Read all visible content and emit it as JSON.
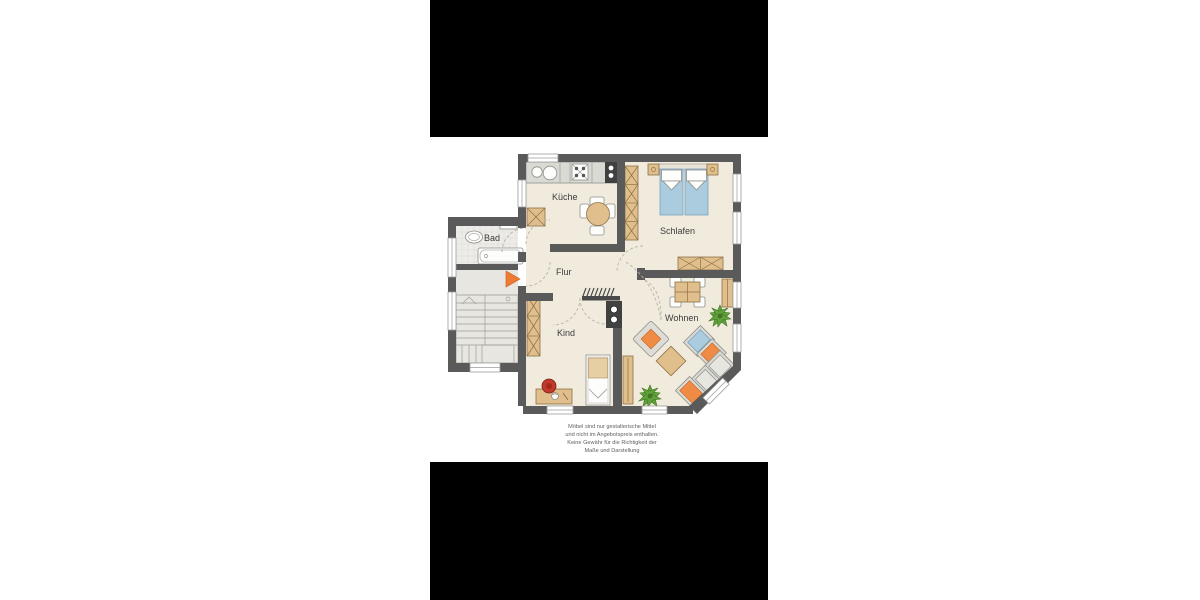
{
  "page": {
    "background": "#ffffff",
    "letterbox_color": "#000000"
  },
  "floorplan": {
    "rooms": [
      {
        "id": "kueche",
        "label": "Küche"
      },
      {
        "id": "schlafen",
        "label": "Schlafen"
      },
      {
        "id": "bad",
        "label": "Bad"
      },
      {
        "id": "flur",
        "label": "Flur"
      },
      {
        "id": "kind",
        "label": "Kind"
      },
      {
        "id": "wohnen",
        "label": "Wohnen"
      }
    ],
    "disclaimer": {
      "line1": "Möbel sind nur gestalterische Mittel",
      "line2": "und nicht im Angebotspreis enthalten.",
      "line3": "Keine Gewähr für die Richtigkeit der",
      "line4": "Maße und Darstellung"
    },
    "icons": [
      "stairs-icon",
      "entrance-arrow-icon",
      "bathtub-icon",
      "washbasin-icon",
      "toilet-icon",
      "kitchen-counter-icon",
      "sink-icon",
      "cooktop-icon",
      "oven-icon",
      "shaft-icon",
      "dining-table-icon",
      "chair-icon",
      "double-bed-icon",
      "nightstand-icon",
      "wardrobe-icon",
      "coat-rack-icon",
      "chimney-icon",
      "sofa-icon",
      "armchair-icon",
      "coffee-table-icon",
      "plant-icon",
      "single-bed-icon",
      "desk-icon",
      "desk-lamp-icon",
      "sideboard-icon",
      "window-icon",
      "door-arc"
    ],
    "colors": {
      "wall": "#5a5a5a",
      "floor": "#f1ebdd",
      "bath_floor": "#edece8",
      "furniture_tan": "#e0bf8d",
      "bed_blue": "#abcbdf",
      "accent_orange": "#ef8b44",
      "plant_green": "#5fa23a",
      "lamp_red": "#c13a2c",
      "counter_gray": "#dadad5"
    }
  }
}
